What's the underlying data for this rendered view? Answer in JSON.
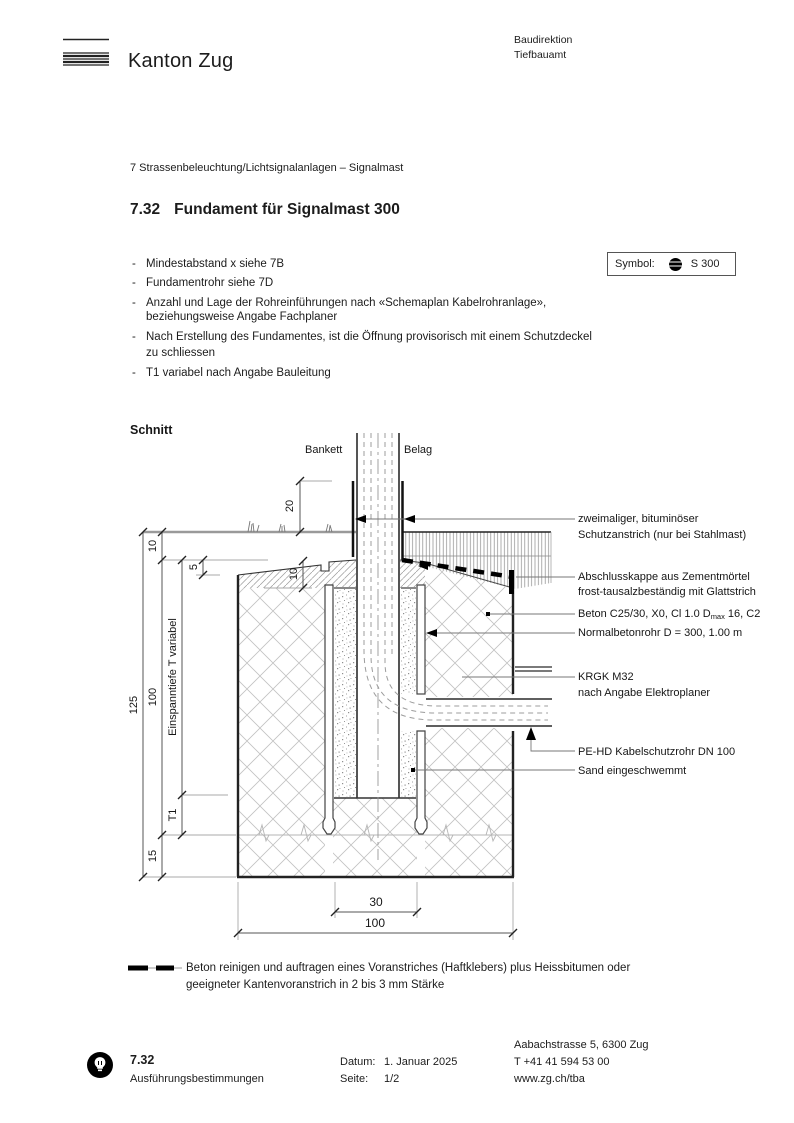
{
  "header": {
    "brand": "Kanton Zug",
    "org_line1": "Baudirektion",
    "org_line2": "Tiefbauamt"
  },
  "doc": {
    "breadcrumb": "7 Strassenbeleuchtung/Lichtsignalanlagen – Signalmast",
    "section_no": "7.32",
    "title": "Fundament für Signalmast 300"
  },
  "symbol_box": {
    "label": "Symbol:",
    "code": "S 300"
  },
  "notes_lines": [
    {
      "dash": "-",
      "text": "Mindestabstand x siehe 7B"
    },
    {
      "dash": "-",
      "text": "Fundamentrohr siehe 7D"
    },
    {
      "dash": "-",
      "text": "Anzahl und Lage der Rohreinführungen nach «Schemaplan Kabelrohranlage»,"
    },
    {
      "dash": "",
      "text": "beziehungsweise Angabe Fachplaner"
    },
    {
      "dash": "-",
      "text": "Nach Erstellung des Fundamentes, ist die Öffnung provisorisch mit einem Schutzdeckel"
    },
    {
      "dash": "",
      "text": "zu schliessen"
    },
    {
      "dash": "-",
      "text": "T1 variabel nach Angabe Bauleitung"
    }
  ],
  "drawing": {
    "heading": "Schnitt",
    "labels": {
      "bankett": "Bankett",
      "belag": "Belag"
    },
    "dims": {
      "d20": "20",
      "d10_top": "10",
      "d5": "5",
      "d10_cap": "10",
      "d125": "125",
      "d100_v": "100",
      "d15": "15",
      "t1": "T1",
      "einspanntiefe": "Einspanntiefe T variabel",
      "d30": "30",
      "d100_h": "100"
    },
    "annotations": {
      "schutzanstrich_1": "zweimaliger, bituminöser",
      "schutzanstrich_2": "Schutzanstrich (nur bei Stahlmast)",
      "abschlusskappe_1": "Abschlusskappe aus Zementmörtel",
      "abschlusskappe_2": "frost-tausalzbeständig mit Glattstrich",
      "beton_pre": "Beton C25/30, X0, Cl 1.0 D",
      "beton_sub": "max",
      "beton_post": " 16, C2",
      "normalbetonrohr": "Normalbetonrohr D = 300, 1.00 m",
      "krgk_1": "KRGK M32",
      "krgk_2": "nach Angabe Elektroplaner",
      "pehd": "PE-HD Kabelschutzrohr DN 100",
      "sand": "Sand eingeschwemmt"
    }
  },
  "legend": {
    "line1": "Beton reinigen und auftragen eines Voranstriches (Haftklebers) plus Heissbitumen oder",
    "line2": "geeigneter Kantenvoranstrich in 2 bis 3 mm Stärke"
  },
  "footer": {
    "section_no": "7.32",
    "doc_type": "Ausführungsbestimmungen",
    "date_label": "Datum:",
    "date": "1. Januar 2025",
    "page_label": "Seite:",
    "page": "1/2",
    "address": "Aabachstrasse 5, 6300 Zug",
    "phone": "T +41 41 594 53 00",
    "web": "www.zg.ch/tba"
  }
}
